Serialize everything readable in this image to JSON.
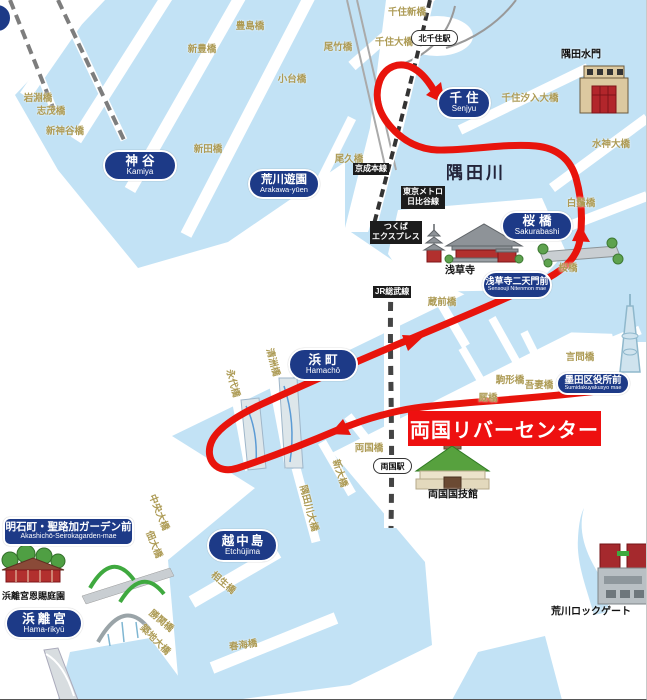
{
  "map": {
    "colors": {
      "water_blue": "#c2e2f5",
      "route_red": "#e8140c",
      "station_navy": "#1d3a87",
      "bridge_text_olive": "#ad9b55",
      "highlight_red": "#ee1010"
    },
    "river": {
      "label": "隅田川"
    },
    "highlight": {
      "label": "両国リバーセンター"
    },
    "stations": [
      {
        "ja": "千住",
        "en": "Senjyu"
      },
      {
        "ja": "神谷",
        "en": "Kamiya"
      },
      {
        "ja": "荒川遊園",
        "en": "Arakawa-yūen"
      },
      {
        "ja": "桜橋",
        "en": "Sakurabashi"
      },
      {
        "ja": "浅草寺二天門前",
        "en": "Sensouji Nitenmon mae"
      },
      {
        "ja": "墨田区役所前",
        "en": "Sumidakuyakusyo mae"
      },
      {
        "ja": "浜町",
        "en": "Hamachō"
      },
      {
        "ja": "越中島",
        "en": "Etchūjima"
      },
      {
        "ja": "明石町・聖路加ガーデン前",
        "en": "Akashichō-Seirokagarden-mae"
      },
      {
        "ja": "浜離宮",
        "en": "Hama-rikyū"
      }
    ],
    "station_signs": [
      {
        "label": "北千住駅"
      },
      {
        "label": "両国駅"
      }
    ],
    "rail_lines": [
      {
        "line1": "京成本線",
        "line2": ""
      },
      {
        "line1": "東京メトロ",
        "line2": "日比谷線"
      },
      {
        "line1": "つくば",
        "line2": "エクスプレス"
      },
      {
        "line1": "JR総武線",
        "line2": ""
      }
    ],
    "bridges": [
      {
        "label": "豊島橋"
      },
      {
        "label": "新豊橋"
      },
      {
        "label": "小台橋"
      },
      {
        "label": "岩淵橋"
      },
      {
        "label": "志茂橋"
      },
      {
        "label": "新神谷橋"
      },
      {
        "label": "新田橋"
      },
      {
        "label": "尾竹橋"
      },
      {
        "label": "千住新橋"
      },
      {
        "label": "千住大橋"
      },
      {
        "label": "千住汐入大橋"
      },
      {
        "label": "水神大橋"
      },
      {
        "label": "尾久橋"
      },
      {
        "label": "白鬚橋"
      },
      {
        "label": "桜橋"
      },
      {
        "label": "言問橋"
      },
      {
        "label": "蔵前橋"
      },
      {
        "label": "駒形橋"
      },
      {
        "label": "吾妻橋"
      },
      {
        "label": "厩橋"
      },
      {
        "label": "両国橋"
      },
      {
        "label": "新大橋"
      },
      {
        "label": "隅田川大橋"
      },
      {
        "label": "清洲橋"
      },
      {
        "label": "永代橋"
      },
      {
        "label": "中央大橋"
      },
      {
        "label": "佃大橋"
      },
      {
        "label": "相生橋"
      },
      {
        "label": "勝鬨橋"
      },
      {
        "label": "築地大橋"
      },
      {
        "label": "春海橋"
      }
    ],
    "landmarks": [
      {
        "label": "隅田水門"
      },
      {
        "label": "浅草寺"
      },
      {
        "label": "両国国技館"
      },
      {
        "label": "荒川ロックゲート"
      },
      {
        "label": "浜離宮恩賜庭園"
      }
    ]
  }
}
